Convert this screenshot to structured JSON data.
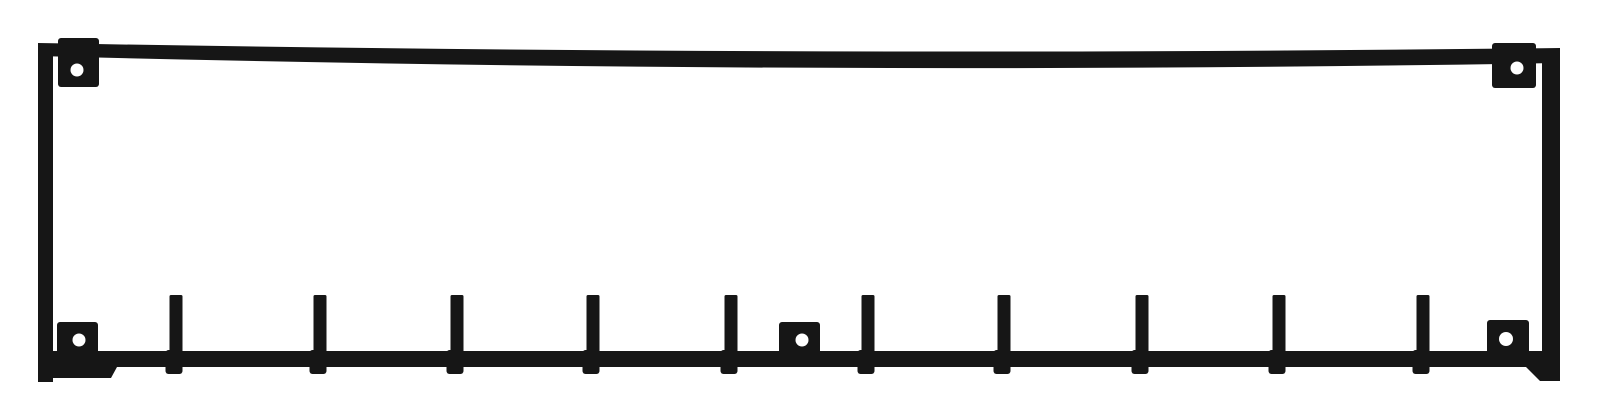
{
  "image": {
    "subject": "black-metal-wall-coat-rack",
    "background_color": "#ffffff",
    "metal_color": "#161616",
    "hole_color": "#ffffff",
    "width": 1600,
    "height": 415
  },
  "rack": {
    "frame": {
      "top_bar": {
        "x1": 38,
        "x2": 1560,
        "top_edge": {
          "y1": 43,
          "yc": 57,
          "y2": 48
        },
        "bottom_edge": {
          "y1": 56,
          "yc": 76,
          "y2": 63
        }
      },
      "left_bar": {
        "x": 38,
        "w": 15,
        "y1": 44,
        "y2": 382
      },
      "right_bar": {
        "x": 1542,
        "w": 18,
        "y1": 49,
        "y2": 381
      },
      "bottom_bar": {
        "points": [
          [
            44,
            351
          ],
          [
            1556,
            351
          ],
          [
            1556,
            381
          ],
          [
            1540,
            381
          ],
          [
            1526,
            367
          ],
          [
            117,
            367
          ],
          [
            111,
            378
          ],
          [
            44,
            378
          ]
        ]
      }
    },
    "hooks": {
      "count": 10,
      "centers_x": [
        176,
        320,
        457,
        593,
        731,
        868,
        1004,
        1142,
        1279,
        1423
      ],
      "post_top_y": 295,
      "post_bottom_y": 354,
      "post_width": 13,
      "tip_width": 17,
      "tip_top_y": 350,
      "tip_bottom_y": 374,
      "tip_offset_x": -2
    },
    "mounting_plates": [
      {
        "name": "top-left",
        "x": 58,
        "y": 38,
        "w": 41,
        "h": 49,
        "hole": {
          "cx": 77,
          "cy": 70,
          "r": 6.5
        }
      },
      {
        "name": "top-right",
        "x": 1492,
        "y": 43,
        "w": 44,
        "h": 45,
        "hole": {
          "cx": 1517,
          "cy": 68,
          "r": 6.5
        }
      },
      {
        "name": "bottom-left",
        "x": 57,
        "y": 322,
        "w": 41,
        "h": 40,
        "hole": {
          "cx": 79,
          "cy": 340,
          "r": 6.5
        }
      },
      {
        "name": "bottom-center",
        "x": 779,
        "y": 322,
        "w": 41,
        "h": 36,
        "hole": {
          "cx": 802,
          "cy": 340,
          "r": 6.5
        }
      },
      {
        "name": "bottom-right",
        "x": 1487,
        "y": 320,
        "w": 42,
        "h": 35,
        "hole": {
          "cx": 1506,
          "cy": 339,
          "r": 7
        }
      }
    ]
  }
}
